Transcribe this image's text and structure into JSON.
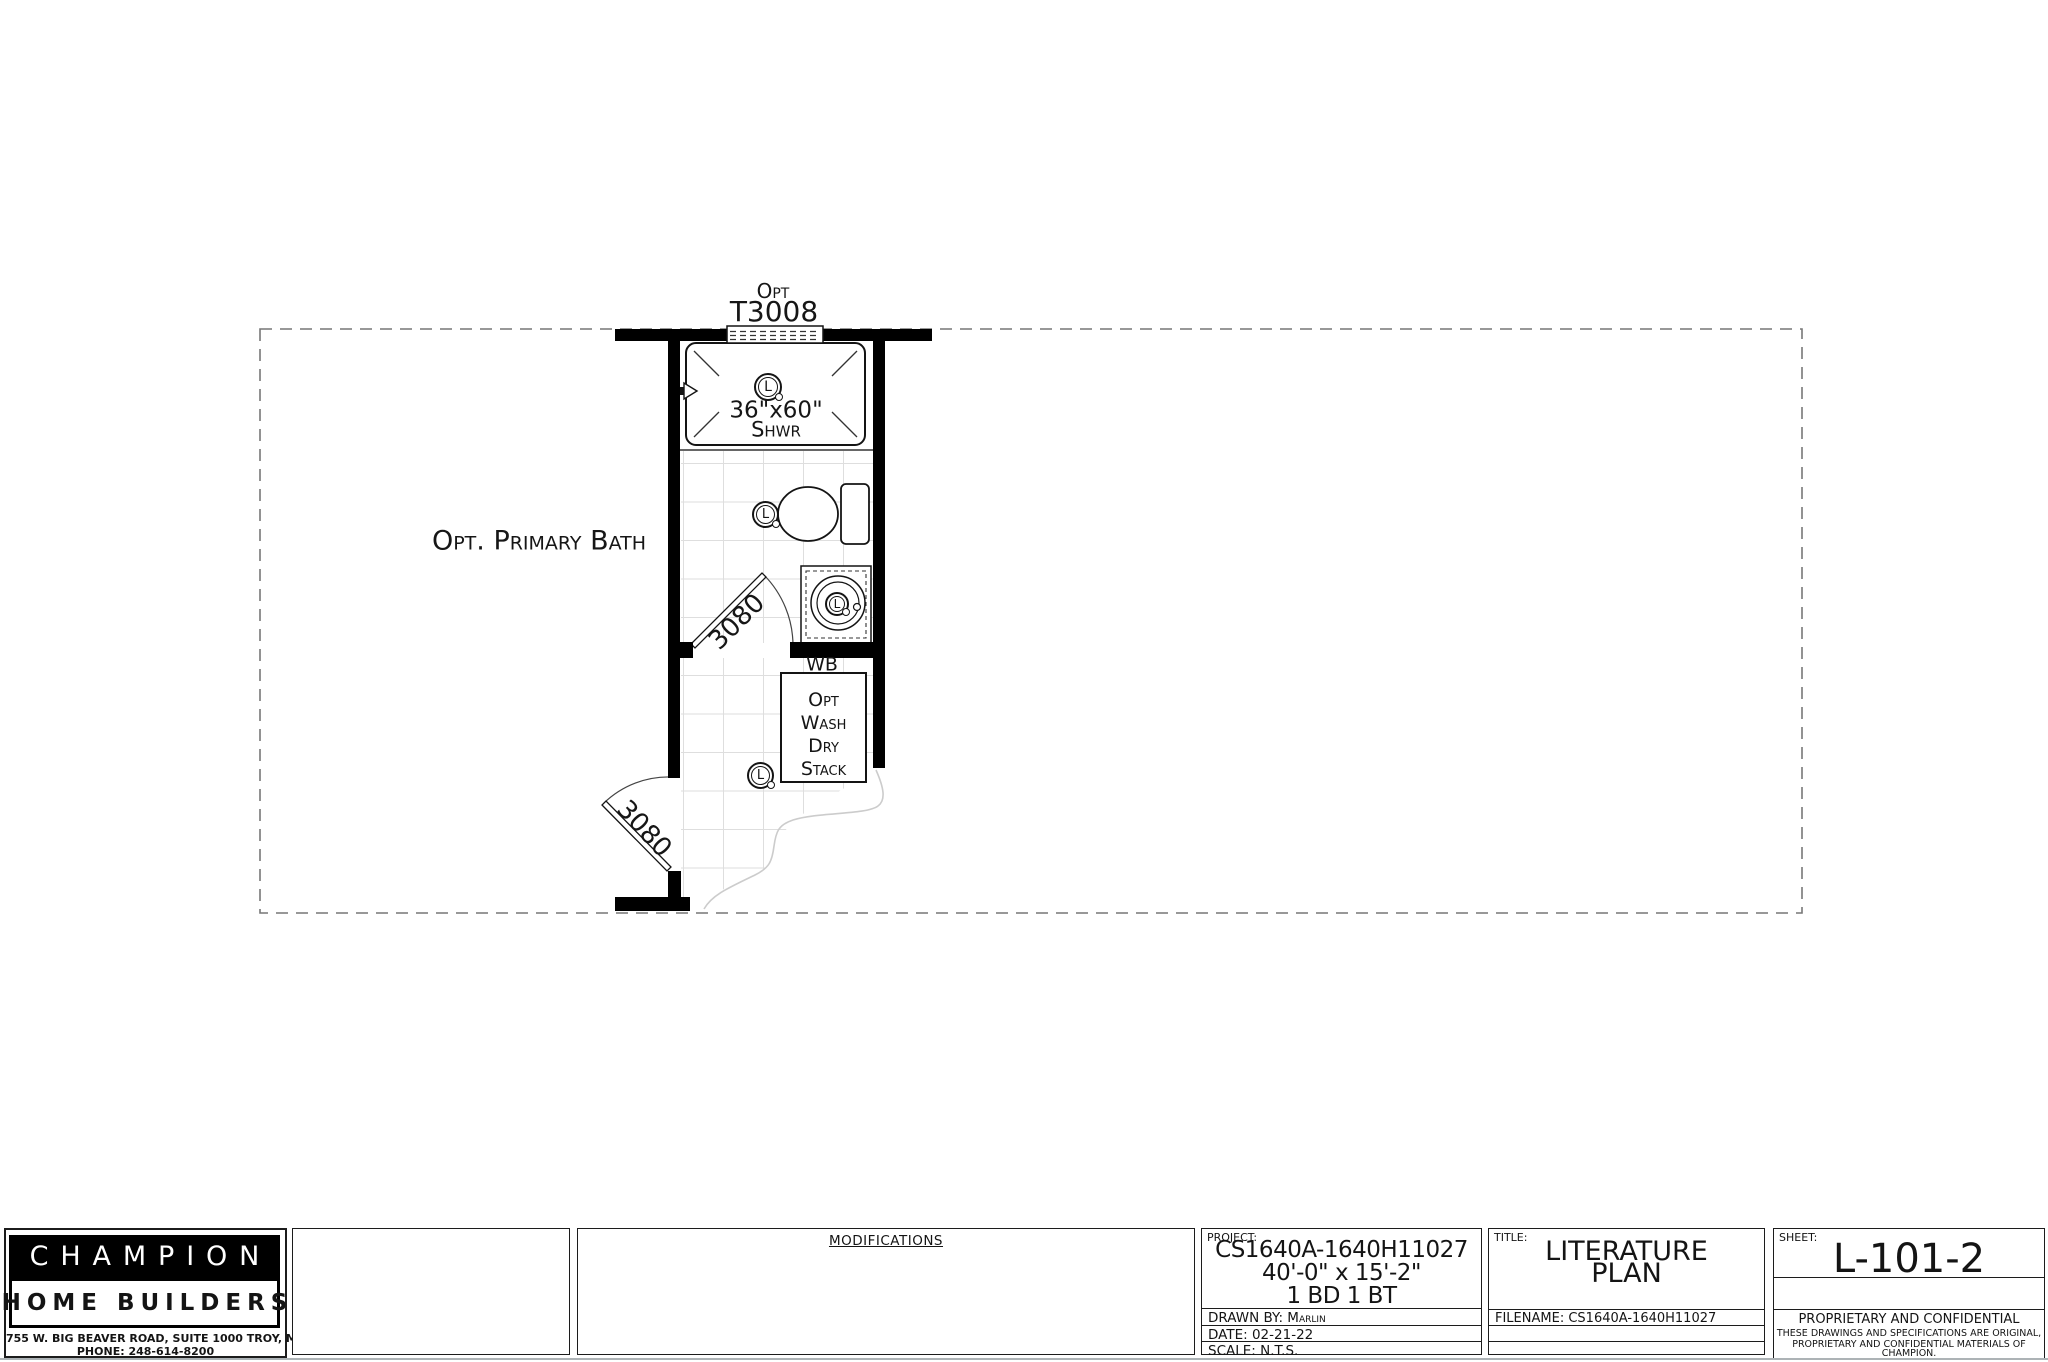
{
  "plan": {
    "window_label": {
      "line1": "Opt",
      "line2": "T3008"
    },
    "room_label": "Opt. Primary Bath",
    "shower": {
      "size": "36\"x60\"",
      "abbr": "Shwr"
    },
    "door_upper": "3080",
    "door_lower": "3080",
    "wb_label": "WB",
    "laundry": {
      "lines": [
        "Opt",
        "Wash",
        "Dry",
        "Stack"
      ]
    },
    "fixture_letter": "L"
  },
  "title_block": {
    "company": {
      "name": "CHAMPION",
      "sub": "HOME BUILDERS",
      "address": "755 W. BIG BEAVER ROAD, SUITE 1000  TROY, MI  48084",
      "phone": "PHONE: 248-614-8200"
    },
    "modifications": {
      "header": "MODIFICATIONS"
    },
    "project": {
      "label": "PROJECT:",
      "model": "CS1640A-1640H11027",
      "dims": "40'-0\" x 15'-2\"",
      "rooms": "1 BD 1 BT",
      "drawn_by_label": "DRAWN BY:",
      "drawn_by": "Marlin",
      "date_label": "DATE:",
      "date": "02-21-22",
      "scale_label": "SCALE:",
      "scale": "N.T.S."
    },
    "title": {
      "label": "TITLE:",
      "line1": "LITERATURE",
      "line2": "PLAN",
      "filename_label": "FILENAME:",
      "filename": "CS1640A-1640H11027"
    },
    "sheet": {
      "label": "SHEET:",
      "number": "L-101-2",
      "confidential_title": "PROPRIETARY AND CONFIDENTIAL",
      "confidential_line1": "THESE DRAWINGS AND SPECIFICATIONS ARE ORIGINAL,",
      "confidential_line2": "PROPRIETARY AND CONFIDENTIAL MATERIALS OF CHAMPION.",
      "copyright": "COPYRIGHT © 1976-2022 BY CHAMPION"
    }
  },
  "colors": {
    "wall": "#000000",
    "line": "#141414",
    "grid": "#dedede",
    "boundary_dash": "#777777"
  }
}
